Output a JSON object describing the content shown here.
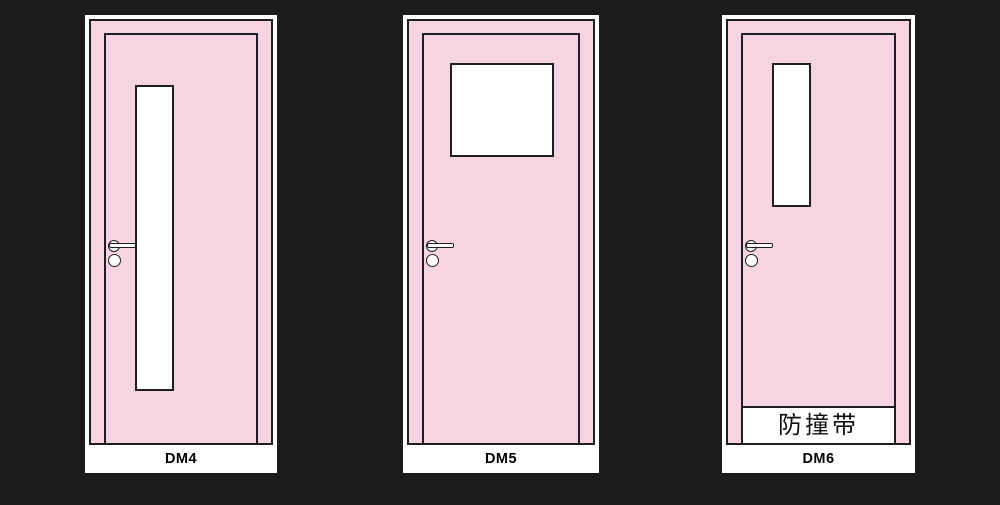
{
  "colors": {
    "background": "#1b1b1c",
    "card": "#ffffff",
    "door_pink": "#f7d4e2",
    "outline": "#1f1f23",
    "glass": "#ffffff",
    "label_text": "#000000"
  },
  "icons": {
    "lever_handle": "circle-with-horizontal-bar",
    "lock_cylinder": "small-circle"
  },
  "doors": [
    {
      "label": "DM4"
    },
    {
      "label": "DM5"
    },
    {
      "label": "DM6",
      "bumper_label": "防撞带"
    }
  ]
}
